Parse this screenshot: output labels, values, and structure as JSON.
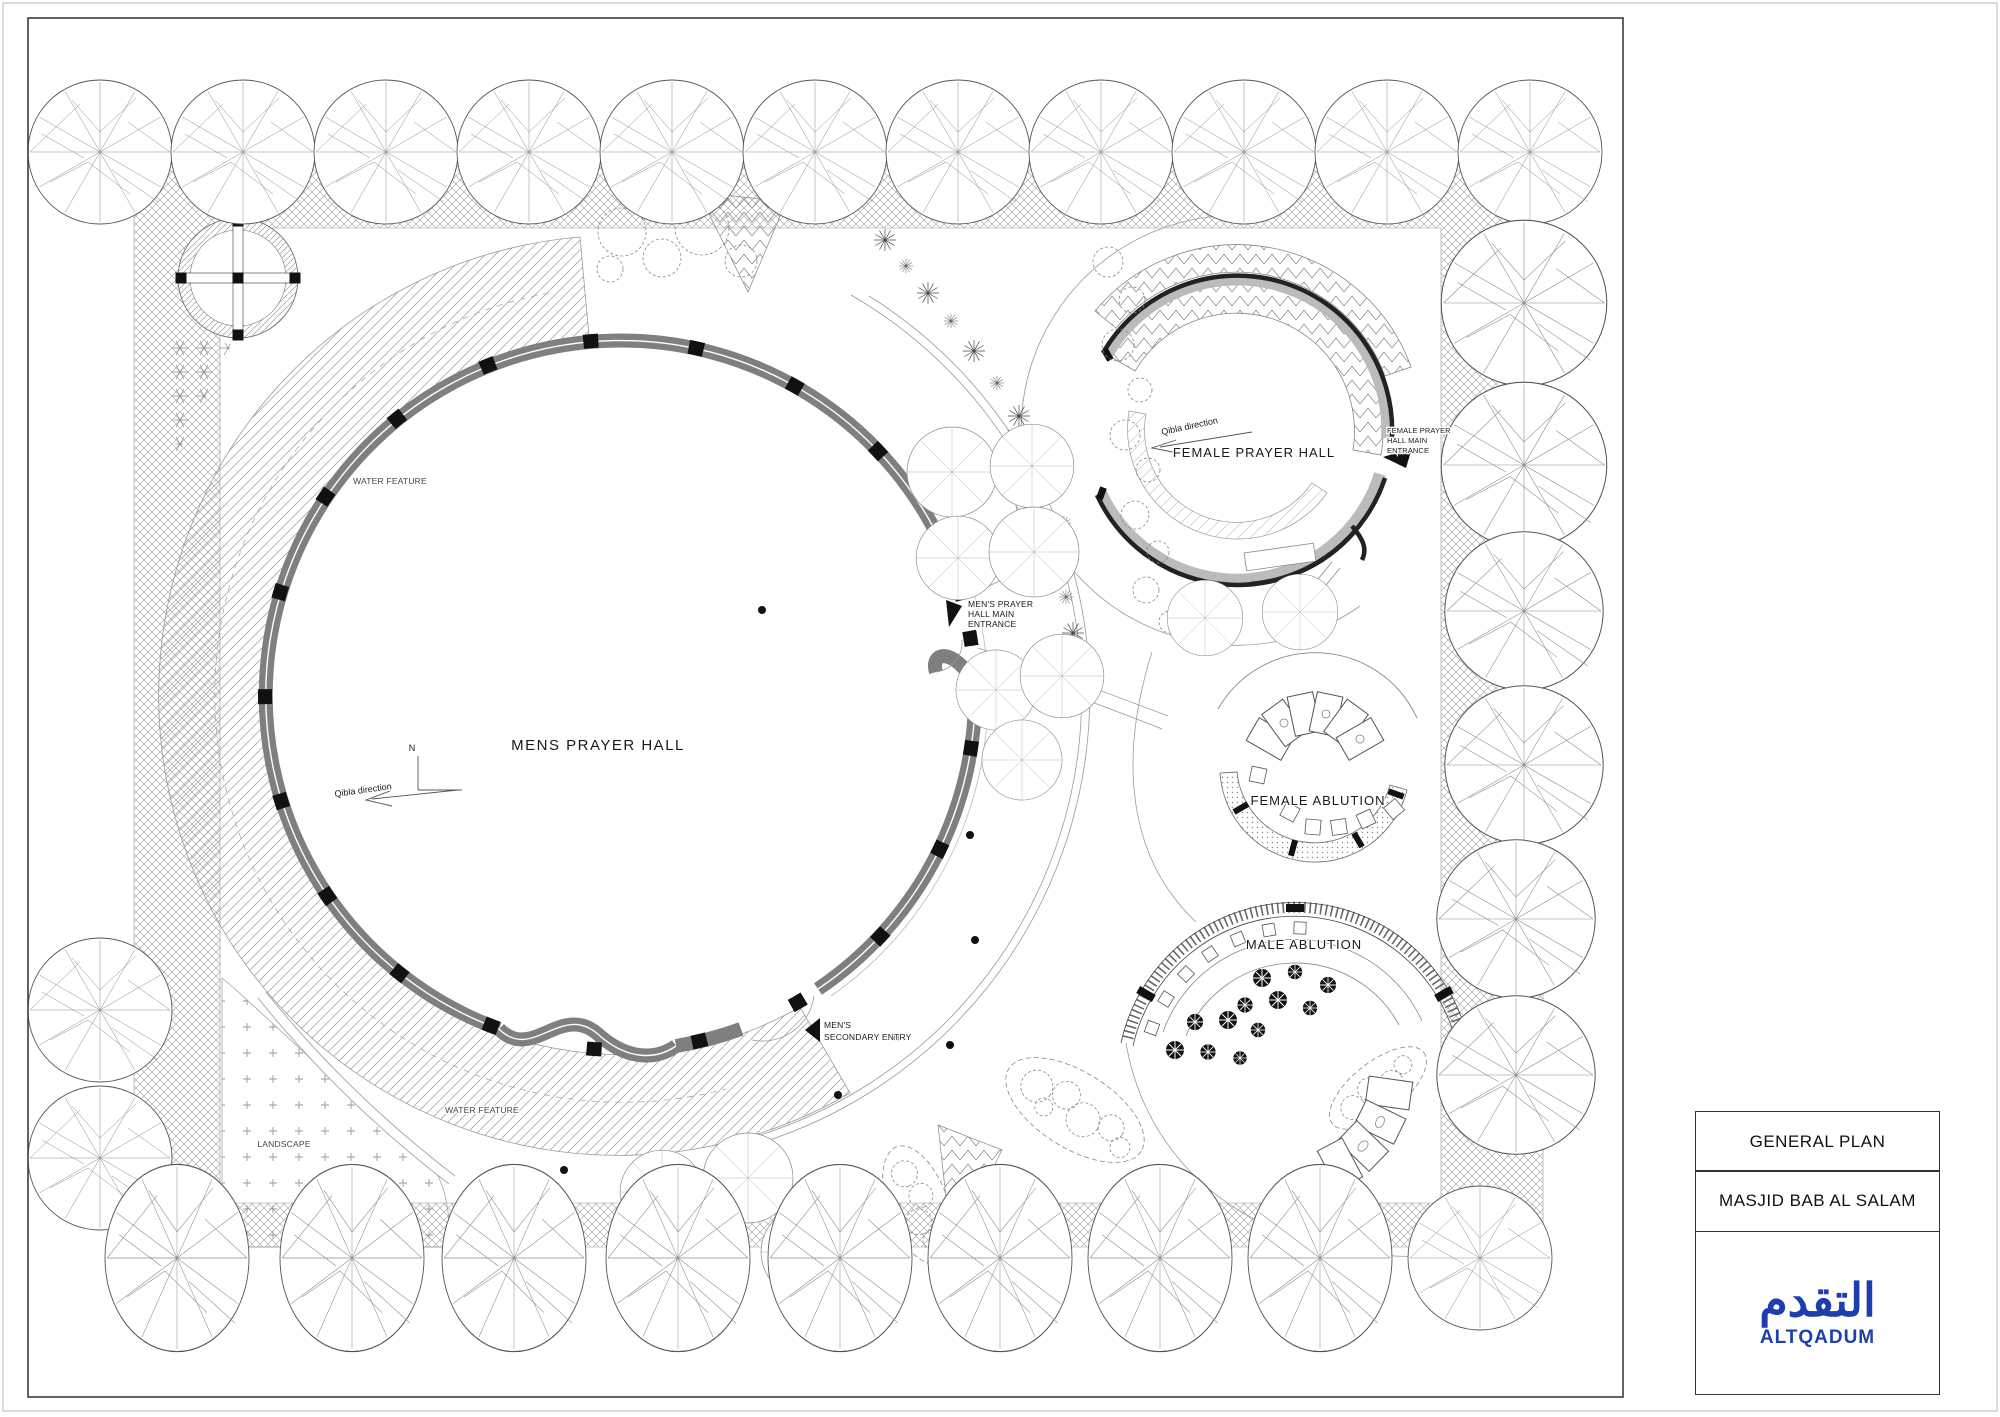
{
  "colors": {
    "accent_blue": "#1d3fae",
    "drawing_line": "#3c3c3c"
  },
  "title_block": {
    "plan_title": "GENERAL PLAN",
    "project_title": "MASJID BAB AL SALAM",
    "brand_arabic": "التقدم",
    "brand_latin": "ALTQADUM"
  },
  "plan": {
    "halls": {
      "mens": {
        "label": "MENS PRAYER HALL"
      },
      "female": {
        "label": "FEMALE PRAYER HALL"
      }
    },
    "ablutions": {
      "female": {
        "label": "FEMALE ABLUTION"
      },
      "male": {
        "label": "MALE ABLUTION"
      }
    },
    "annotations": {
      "water_feature_upper": "WATER FEATURE",
      "water_feature_lower": "WATER FEATURE",
      "landscape": "LANDSCAPE",
      "qibla_mens": "Qibla direction",
      "qibla_female": "Qibla direction",
      "north": "N",
      "mens_main_entrance": {
        "lines": [
          "MEN'S PRAYER",
          "HALL MAIN",
          "ENTRANCE"
        ]
      },
      "mens_secondary_entry": {
        "lines": [
          "MEN'S",
          "SECONDARY ENTRY"
        ]
      },
      "female_main_entrance": {
        "lines": [
          "FEMALE PRAYER",
          "HALL MAIN",
          "ENTRANCE"
        ]
      }
    }
  }
}
